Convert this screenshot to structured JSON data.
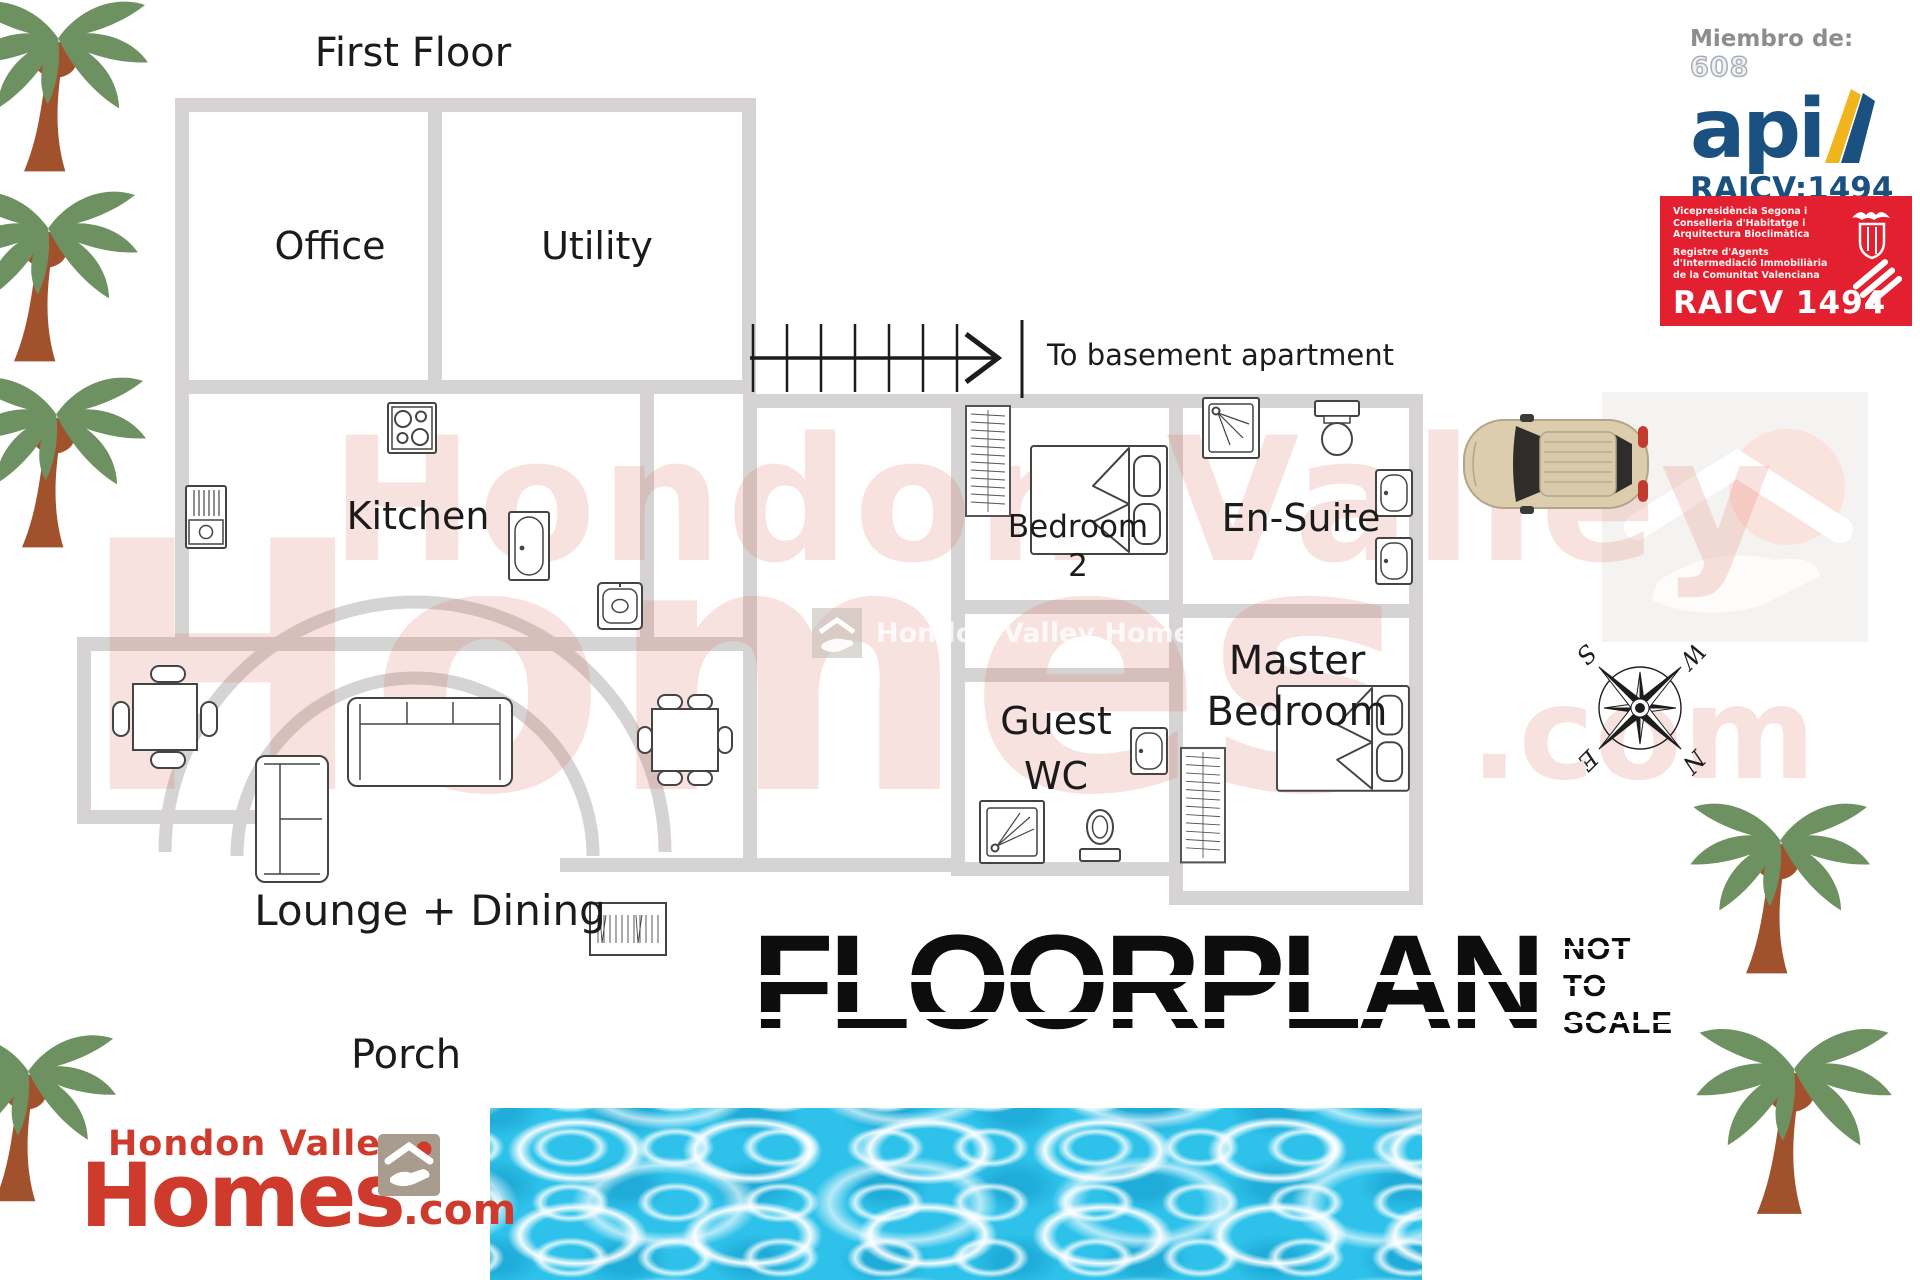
{
  "floor_label": "First Floor",
  "rooms": {
    "office": "Office",
    "utility": "Utility",
    "kitchen": "Kitchen",
    "lounge_dining": "Lounge + Dining",
    "porch": "Porch",
    "bedroom2": {
      "line1": "Bedroom",
      "line2": "2"
    },
    "ensuite": "En-Suite",
    "guest_wc": {
      "line1": "Guest",
      "line2": "WC"
    },
    "master": {
      "line1": "Master",
      "line2": "Bedroom"
    }
  },
  "annotations": {
    "stairs_note": "To basement apartment"
  },
  "stamp": {
    "title": "FLOORPLAN",
    "disclaimer_lines": [
      "NOT",
      "TO",
      "SCALE"
    ]
  },
  "compass": {
    "n": "N",
    "e": "E",
    "s": "S",
    "w": "W"
  },
  "api_logo": {
    "member_label": "Miembro de:",
    "member_number": "608",
    "name": "api",
    "registration": "RAICV:1494"
  },
  "raicv_badge": {
    "dept_lines": [
      "Vicepresidència Segona i",
      "Conselleria d'Habitatge i",
      "Arquitectura Bioclimàtica"
    ],
    "registry_lines": [
      "Registre d'Agents",
      "d'Intermediació Immobiliària",
      "de la Comunitat Valenciana"
    ],
    "code": "RAICV 1494"
  },
  "agency_logo": {
    "top_line": "Hondon Valley",
    "name": "Homes",
    "tld": ".com"
  },
  "watermark": {
    "line1": "Hondon Valley",
    "line2": "Homes",
    "tld": ".com",
    "center_text": "Hondon Valley Homes"
  },
  "icons": {
    "stairs": "stairs-direction-arrow",
    "compass": "compass-rose",
    "car": "car-top-view",
    "palm": "palm-tree",
    "pool": "pool-water-photo",
    "house": "house-in-hand",
    "shower": "shower-tray",
    "toilet": "toilet",
    "sink": "sink-basin",
    "bed": "double-bed",
    "wardrobe": "wardrobe",
    "sofa": "sofa",
    "table": "dining-table",
    "hob": "cooker-hob",
    "radiator": "radiator"
  },
  "colors": {
    "wall": "#d5d3d3",
    "label_text": "#1b1b1b",
    "watermark_pink": "#efc7c0",
    "badge_red": "#e2202f",
    "api_navy": "#1b5180",
    "logo_red": "#ce3a2c",
    "pool_blue": "#2ec2ea",
    "palm_green": "#6d9161",
    "palm_trunk": "#a2512d",
    "car_beige": "#dbcdad"
  }
}
